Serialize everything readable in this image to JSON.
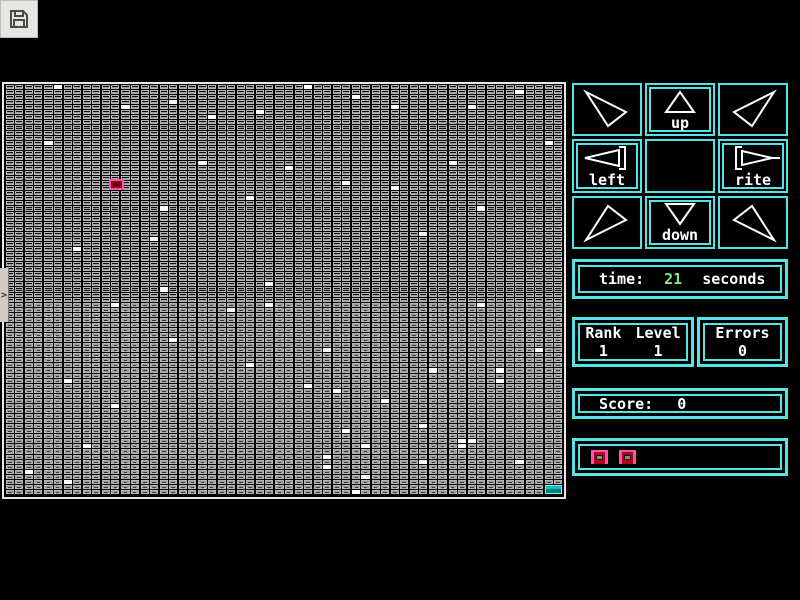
{
  "toolbar": {
    "save_button": "save"
  },
  "side_handle": {
    "chevron": ">"
  },
  "board": {
    "cols": 58,
    "rows": 81,
    "group_size": 2,
    "style_split_row": 43,
    "colors": {
      "cell_border": "#b4b4b4",
      "cell_dark_face": "#101010",
      "cell_light_face": "#9a9a9a",
      "white_cell": "#ffffff",
      "board_border": "#e8e8e8"
    },
    "white_cells": [
      [
        6,
        1
      ],
      [
        32,
        1
      ],
      [
        54,
        2
      ],
      [
        37,
        3
      ],
      [
        18,
        4
      ],
      [
        13,
        5
      ],
      [
        41,
        5
      ],
      [
        49,
        5
      ],
      [
        27,
        6
      ],
      [
        22,
        7
      ],
      [
        5,
        12
      ],
      [
        57,
        12
      ],
      [
        21,
        16
      ],
      [
        47,
        16
      ],
      [
        30,
        17
      ],
      [
        36,
        20
      ],
      [
        41,
        21
      ],
      [
        26,
        23
      ],
      [
        17,
        25
      ],
      [
        50,
        25
      ],
      [
        44,
        30
      ],
      [
        16,
        31
      ],
      [
        8,
        33
      ],
      [
        28,
        40
      ],
      [
        17,
        41
      ],
      [
        12,
        44
      ],
      [
        28,
        44
      ],
      [
        50,
        44
      ],
      [
        24,
        45
      ],
      [
        18,
        51
      ],
      [
        34,
        53
      ],
      [
        56,
        53
      ],
      [
        26,
        56
      ],
      [
        45,
        57
      ],
      [
        52,
        57
      ],
      [
        7,
        59
      ],
      [
        52,
        59
      ],
      [
        32,
        60
      ],
      [
        35,
        61
      ],
      [
        40,
        63
      ],
      [
        12,
        64
      ],
      [
        44,
        68
      ],
      [
        36,
        69
      ],
      [
        48,
        71
      ],
      [
        49,
        71
      ],
      [
        38,
        72
      ],
      [
        48,
        72
      ],
      [
        9,
        72
      ],
      [
        34,
        74
      ],
      [
        44,
        75
      ],
      [
        54,
        75
      ],
      [
        34,
        76
      ],
      [
        3,
        77
      ],
      [
        38,
        78
      ],
      [
        7,
        79
      ],
      [
        37,
        81
      ]
    ],
    "cursor": {
      "col": 12,
      "row": 20,
      "border": "#ff53ab",
      "fill": "#9c0014"
    },
    "goal": {
      "col": 57,
      "row": 81,
      "fill": "#00b2b2",
      "border": "#8ae9e9"
    }
  },
  "dpad": {
    "accent": "#55e3e3",
    "buttons": [
      {
        "id": "up-left",
        "label": ""
      },
      {
        "id": "up",
        "label": "up"
      },
      {
        "id": "up-right",
        "label": ""
      },
      {
        "id": "left",
        "label": "left"
      },
      {
        "id": "center",
        "label": ""
      },
      {
        "id": "rite",
        "label": "rite"
      },
      {
        "id": "down-left",
        "label": ""
      },
      {
        "id": "down",
        "label": "down"
      },
      {
        "id": "down-right",
        "label": ""
      }
    ]
  },
  "stats": {
    "time_label": "time:",
    "time_value": "21",
    "time_unit": "seconds",
    "time_value_color": "#7ee87e",
    "rank_label": "Rank",
    "rank_value": "1",
    "level_label": "Level",
    "level_value": "1",
    "errors_label": "Errors",
    "errors_value": "0",
    "score_label": "Score:",
    "score_value": "0",
    "lives": 2
  }
}
